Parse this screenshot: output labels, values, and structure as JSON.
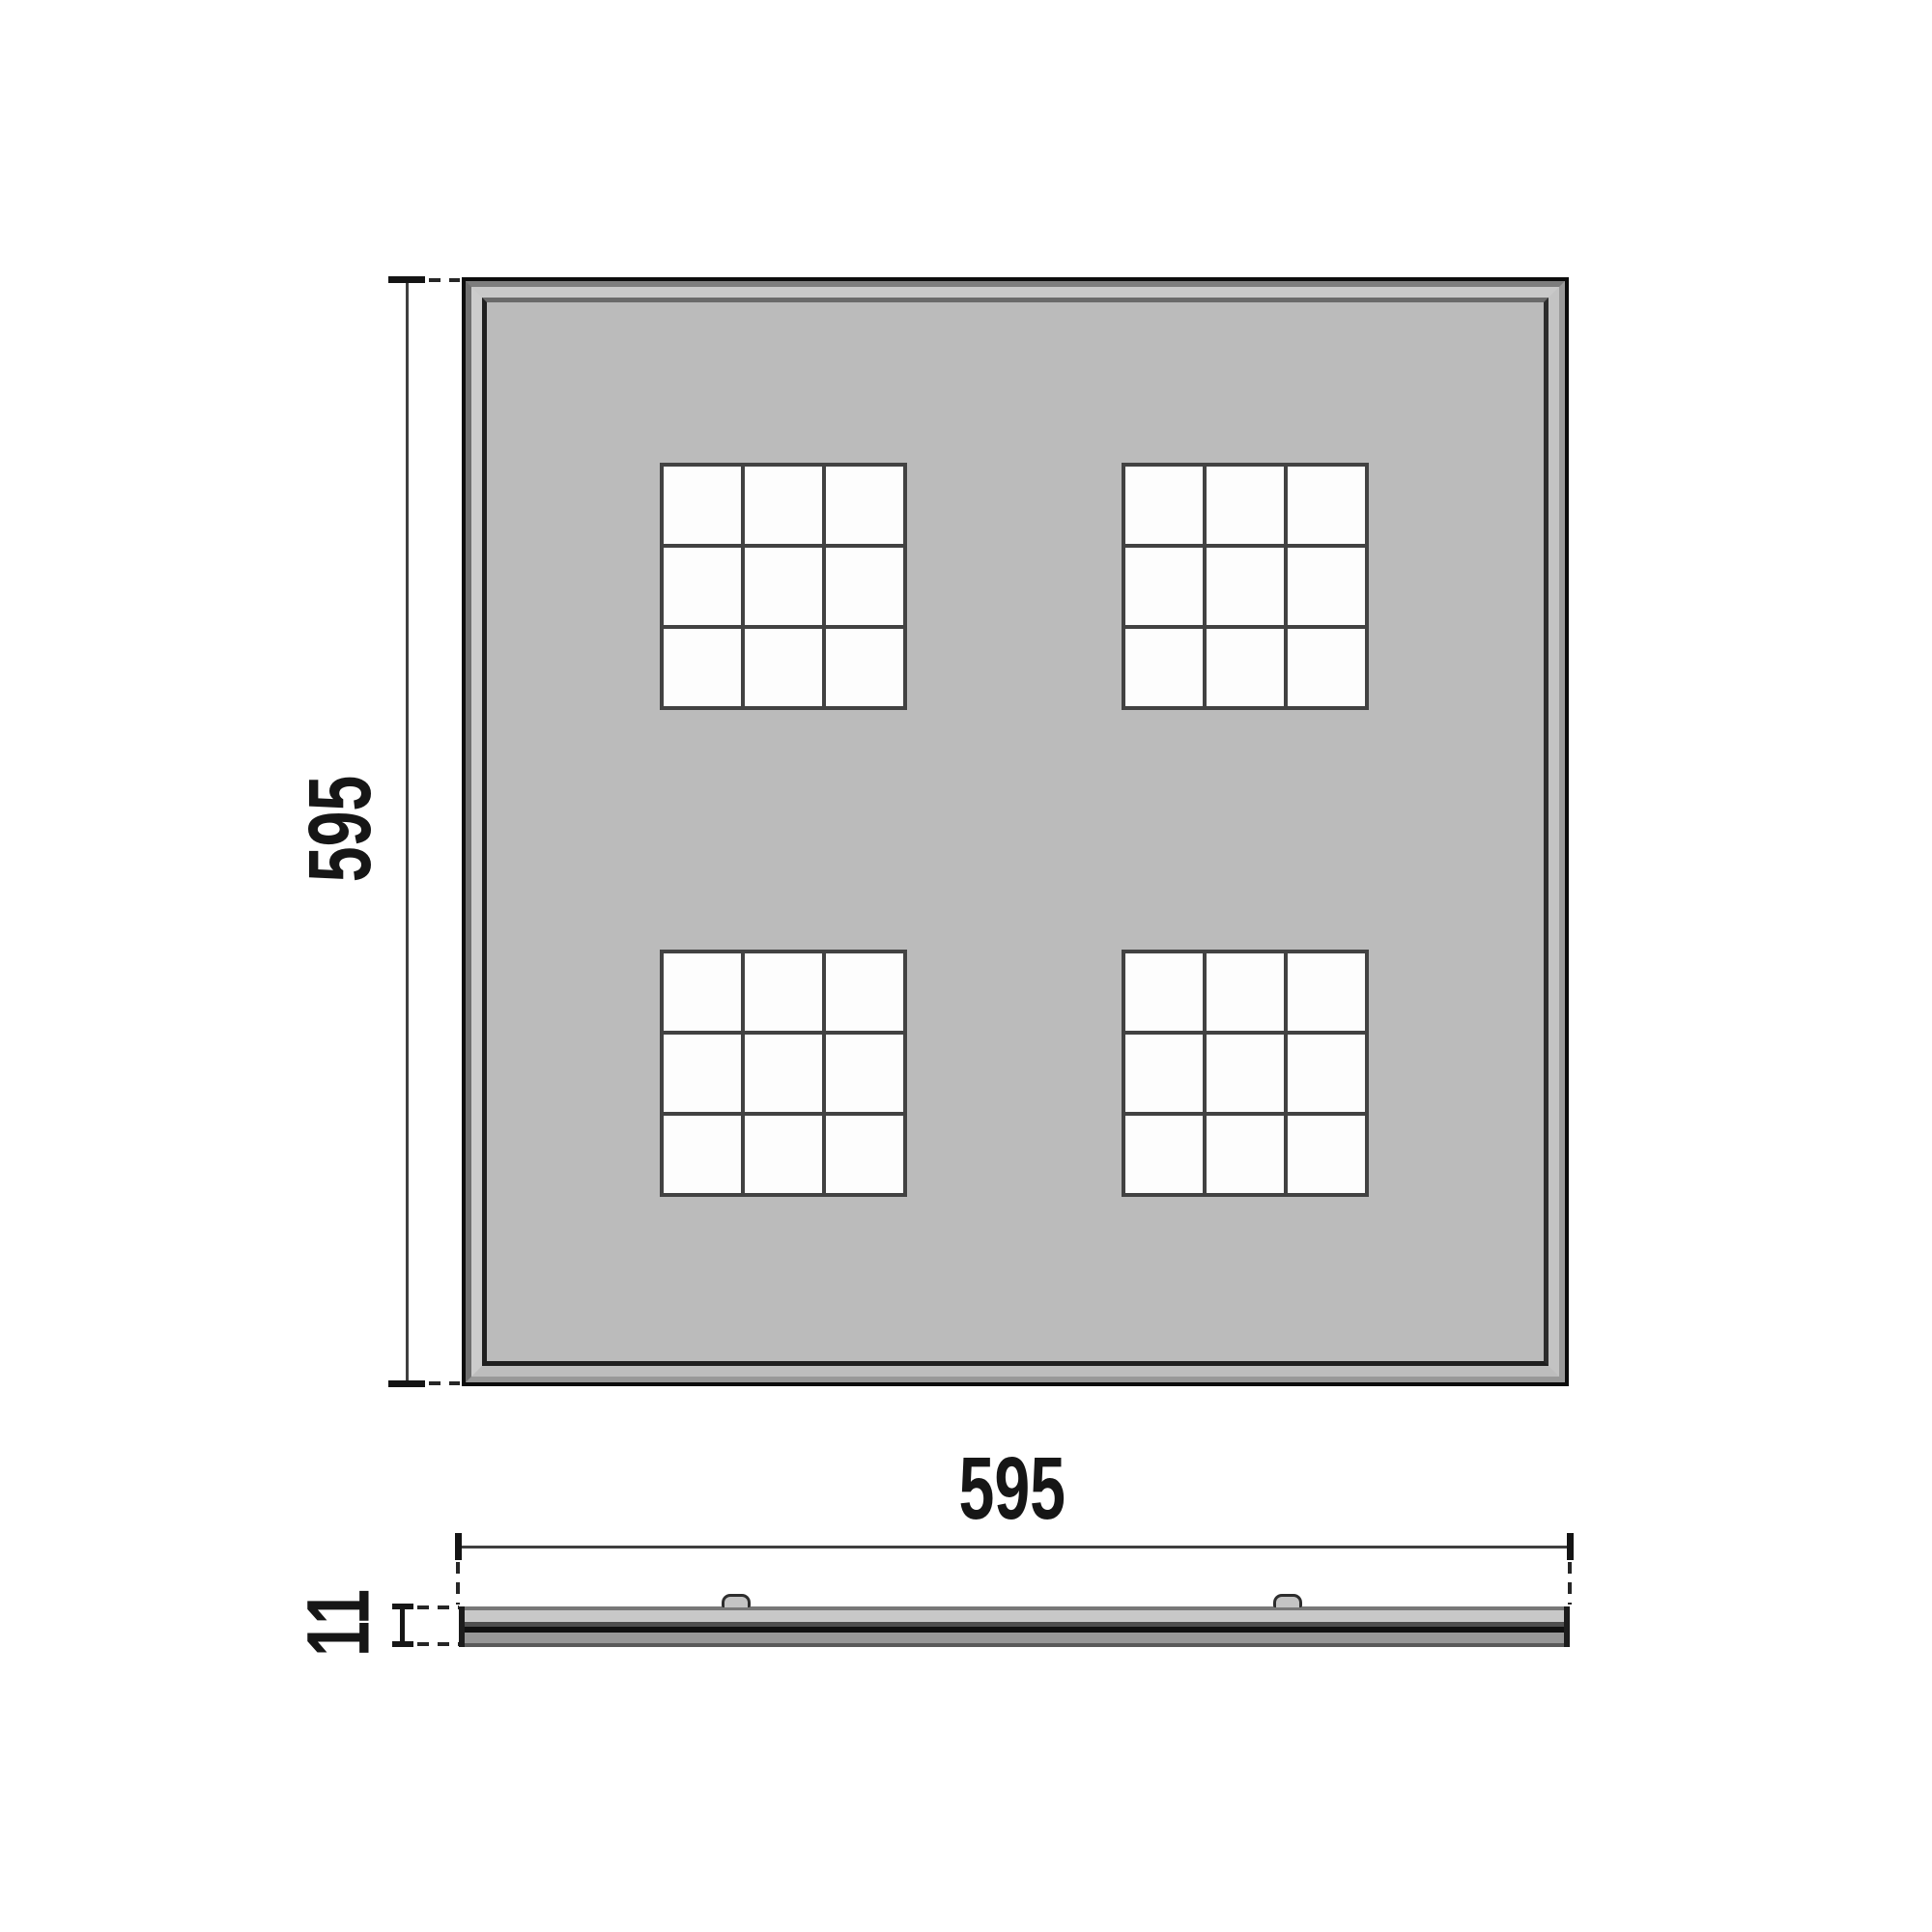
{
  "drawing": {
    "views": {
      "front": {
        "dimensions": {
          "height": {
            "label": "595"
          }
        },
        "modules": {
          "count": 4,
          "rows": 2,
          "cols": 2,
          "cells_per_module": 9,
          "cell_layout": "3x3"
        }
      },
      "side": {
        "dimensions": {
          "width": {
            "label": "595"
          },
          "thickness": {
            "label": "11"
          }
        },
        "clips": {
          "count": 2
        }
      }
    },
    "colors": {
      "background": "#ffffff",
      "panel_face": "#bbbbbb",
      "frame_outer_line": "#0c0c0c",
      "frame_light_bevel": "#c8c8c8",
      "frame_inner_shadow": "#1f1f1f",
      "grid_line": "#424242",
      "cell_fill": "#fdfdfd",
      "dimension_line": "#3f3f3f",
      "label_text": "#161616"
    }
  }
}
